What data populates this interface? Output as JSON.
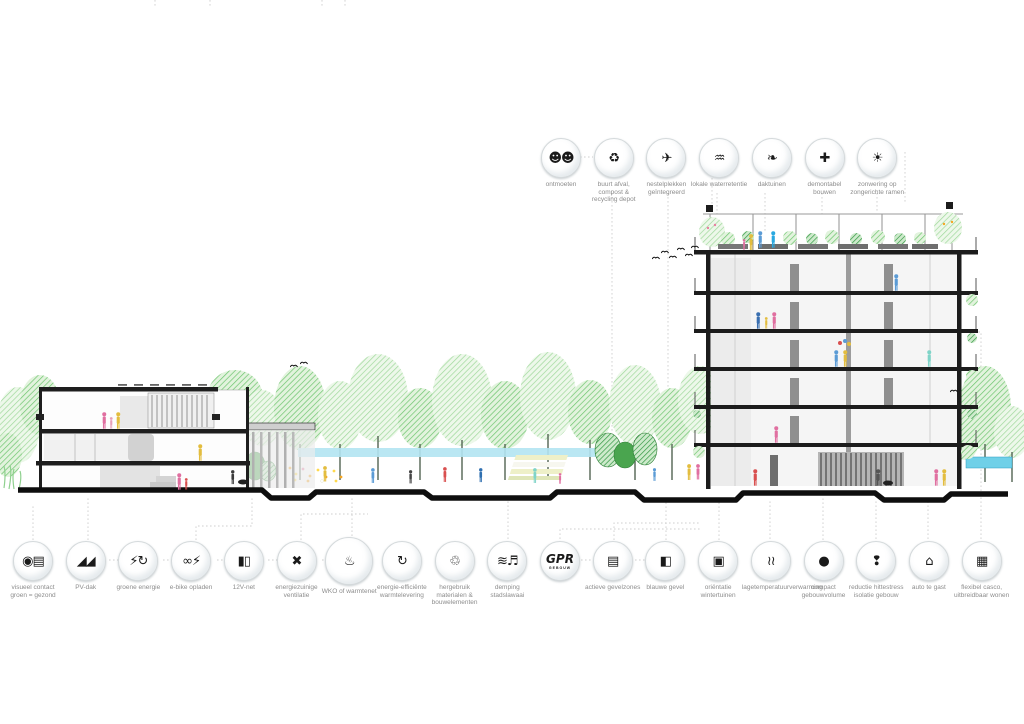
{
  "top_icons": [
    {
      "id": "ontmoeten",
      "label": "ontmoeten",
      "glyph": "☻☻"
    },
    {
      "id": "buurt-afval-compost",
      "label": "buurt afval, compost & recycling depot",
      "glyph": "♻"
    },
    {
      "id": "nestelplekken",
      "label": "nestelplekken geïntegreerd",
      "glyph": "✈"
    },
    {
      "id": "lokale-waterretentie",
      "label": "lokale waterretentie",
      "glyph": "♒"
    },
    {
      "id": "daktuinen",
      "label": "daktuinen",
      "glyph": "❧"
    },
    {
      "id": "demontabel-bouwen",
      "label": "demontabel bouwen",
      "glyph": "✚"
    },
    {
      "id": "zonwering",
      "label": "zonwering op zongerichte ramen",
      "glyph": "☀"
    }
  ],
  "bottom_icons": [
    {
      "id": "visueel-contact-groen",
      "label": "visueel contact groen = gezond",
      "glyph": "◉▤"
    },
    {
      "id": "pv-dak",
      "label": "PV-dak",
      "glyph": "◢◢"
    },
    {
      "id": "groene-energie",
      "label": "groene energie",
      "glyph": "⚡↻"
    },
    {
      "id": "e-bike-opladen",
      "label": "e-bike opladen",
      "glyph": "∞⚡"
    },
    {
      "id": "12v-net",
      "label": "12V-net",
      "glyph": "▮▯"
    },
    {
      "id": "energiezuinige-ventilatie",
      "label": "energiezuinige ventilatie",
      "glyph": "✖"
    },
    {
      "id": "wko-of-warmtenet",
      "label": "WKO of warmtenet",
      "glyph": "♨",
      "big": true
    },
    {
      "id": "energie-efficiente-warmtelevering",
      "label": "energie-efficiënte warmtelevering",
      "glyph": "↻"
    },
    {
      "id": "hergebruik-materialen",
      "label": "hergebruik materialen & bouwelementen",
      "glyph": "♲"
    },
    {
      "id": "demping-stadslawaai",
      "label": "demping stadslawaai",
      "glyph": "≋♬"
    },
    {
      "id": "gpr-gebouw",
      "label": "",
      "glyph": "GPR",
      "sub": "GEBOUW",
      "logo": true
    },
    {
      "id": "actieve-gevelzones",
      "label": "actieve gevelzones",
      "glyph": "▤"
    },
    {
      "id": "blauwe-gevel",
      "label": "blauwe gevel",
      "glyph": "◧"
    },
    {
      "id": "orientatie-wintertuinen",
      "label": "oriëntatie wintertuinen",
      "glyph": "▣"
    },
    {
      "id": "lagetemperatuurverwarming",
      "label": "lagetemperatuurverwarming",
      "glyph": "≀≀"
    },
    {
      "id": "compact-gebouwvolume",
      "label": "compact gebouwvolume",
      "glyph": "●"
    },
    {
      "id": "reductie-hittestress",
      "label": "reductie hittestress isolatie gebouw",
      "glyph": "❢"
    },
    {
      "id": "auto-te-gast",
      "label": "auto te gast",
      "glyph": "⌂"
    },
    {
      "id": "flexibel-casco",
      "label": "flexibel casco, uitbreidbaar wonen",
      "glyph": "▦"
    }
  ],
  "layout_hints": {
    "top_row_start_x": 561,
    "top_row_center_y": 157,
    "bottom_row_start_x": 33,
    "bottom_row_center_y": 560,
    "icon_spacing": 52.7
  },
  "palette": {
    "tree_light": "#9fd89b",
    "tree_mid": "#6cc46e",
    "bush_dark": "#3f9e4d",
    "water": "#b3e4f2",
    "water_deep": "#6fd0e8",
    "ground": "#0e0e0e",
    "slab": "#1c1c1c",
    "icon_border": "#d5dadc",
    "label_text": "#8d8d8d",
    "glyph": "#1a1a1a",
    "leader": "#cfcfcf",
    "figure_pink": "#e06fa0",
    "figure_yellow": "#e3bd3f",
    "figure_blue": "#5b9bd5",
    "figure_red": "#d94f4f",
    "figure_teal": "#7fd4c8"
  }
}
